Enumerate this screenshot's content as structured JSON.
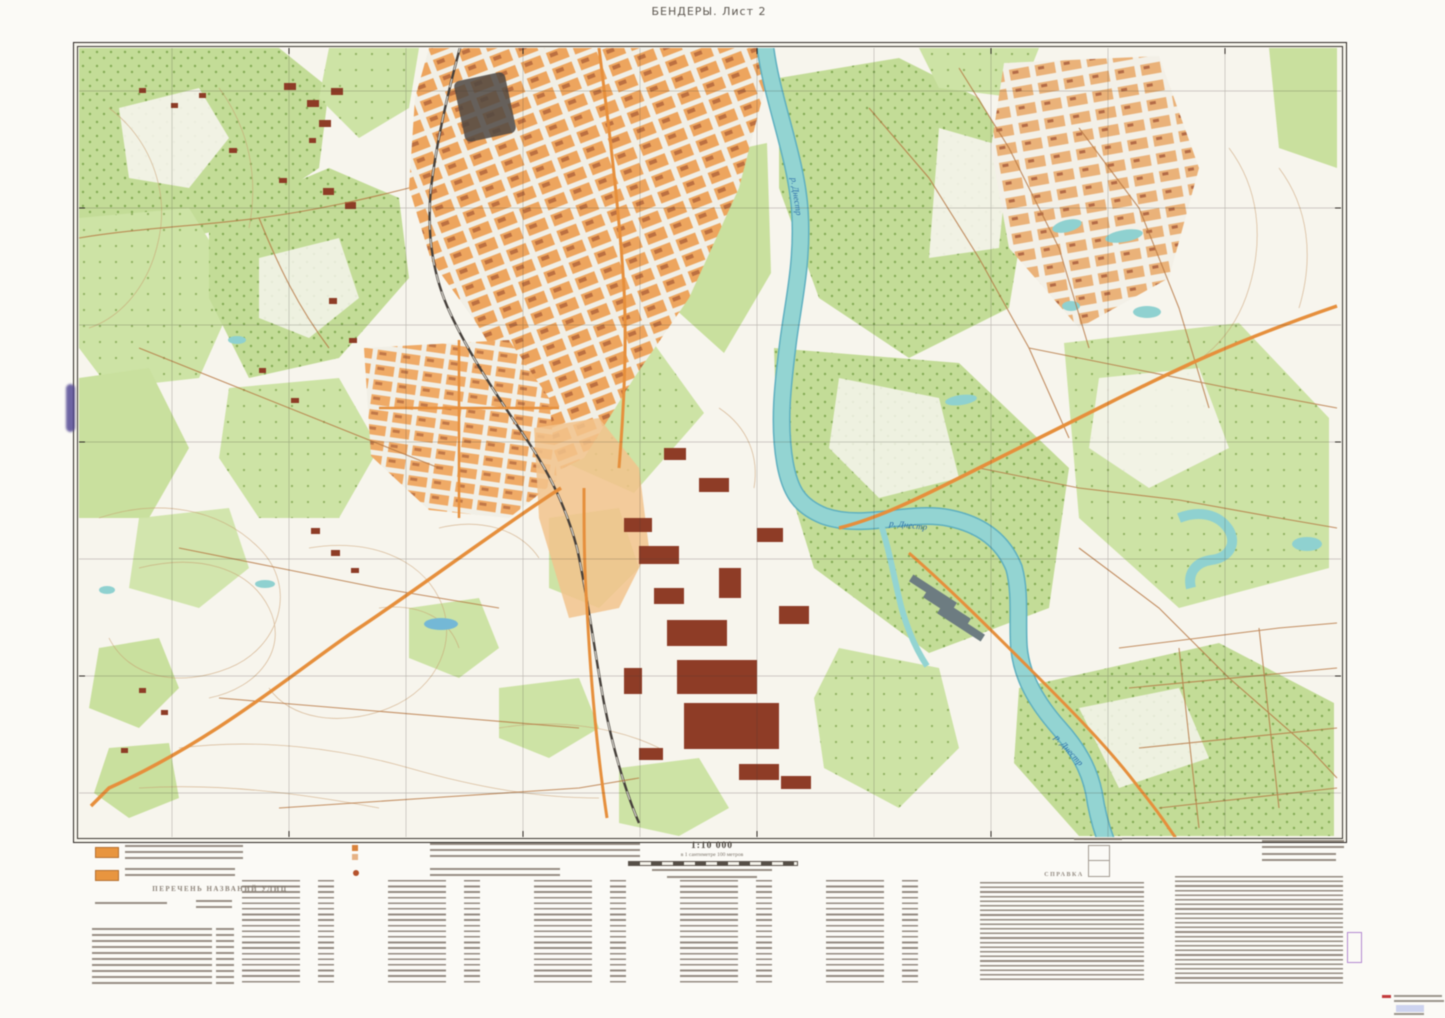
{
  "sheet": {
    "title": "БЕНДЕРЫ. Лист 2"
  },
  "map": {
    "river_label": "р. Днестр"
  },
  "footer": {
    "scale": "1:10 000",
    "scale_caption": "в 1 сантиметре 100 метров",
    "street_index_title": "ПЕРЕЧЕНЬ НАЗВАНИЙ УЛИЦ",
    "reference_title": "СПРАВКА"
  },
  "colors": {
    "vegetation": "#c3dc97",
    "water": "#93d4d2",
    "urban_block": "#eea25c",
    "industrial_building": "#8e3c26",
    "major_road": "#e68f3c",
    "contour": "#c79a6b",
    "frame": "#2c2723",
    "legend_swatch": "#e8953f"
  }
}
